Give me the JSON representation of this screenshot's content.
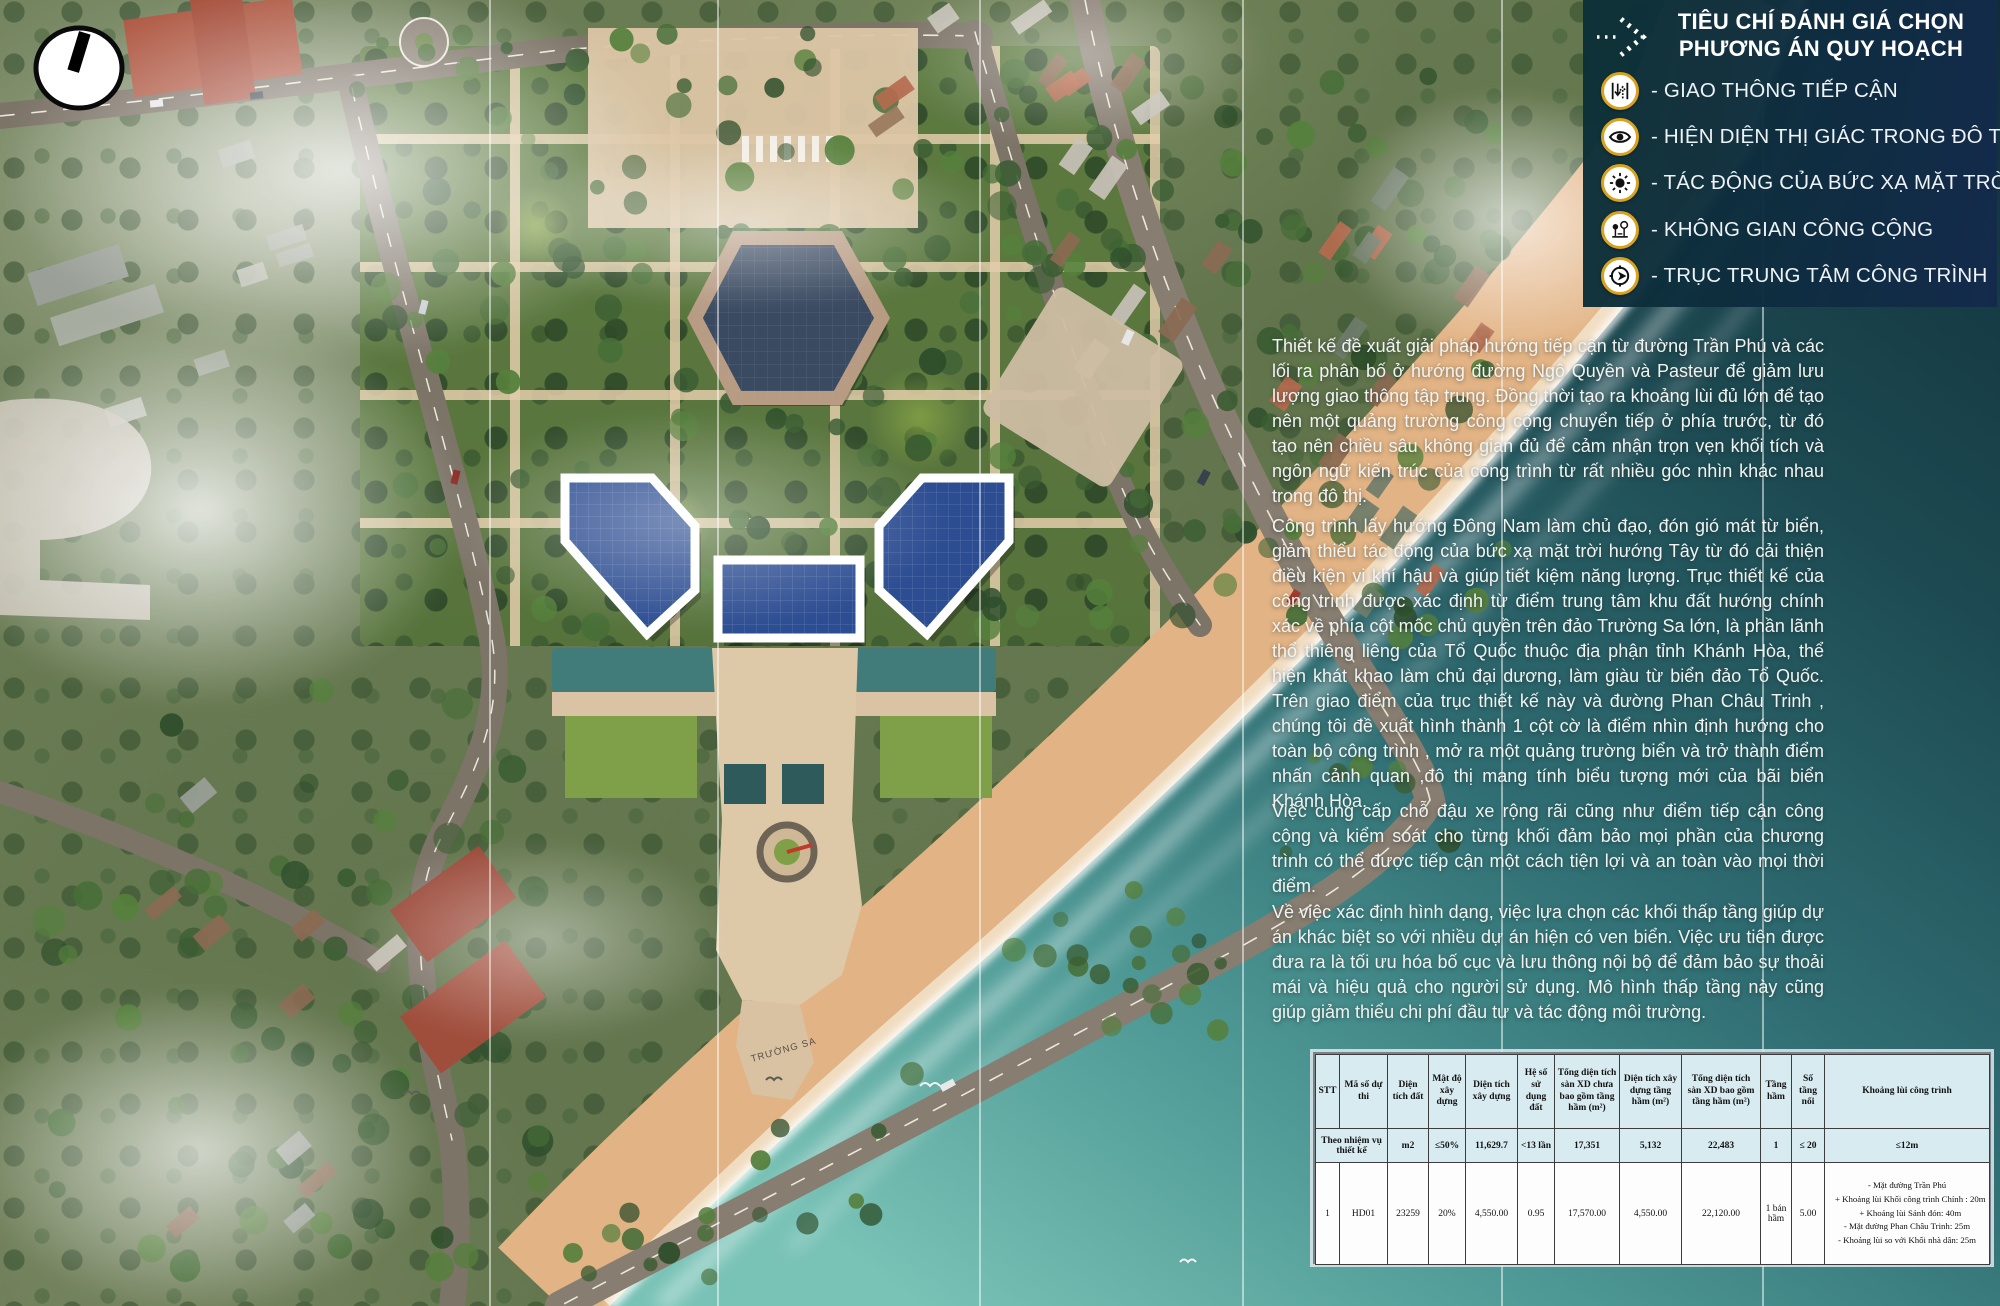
{
  "site": {
    "pier_label": "TRƯỜNG SA"
  },
  "legend": {
    "title_line1": "TIÊU CHÍ ĐÁNH GIÁ CHỌN",
    "title_line2": "PHƯƠNG ÁN QUY HOẠCH",
    "items": [
      {
        "icon": "traffic-access-icon",
        "label": "- GIAO THÔNG TIẾP CẬN"
      },
      {
        "icon": "eye-icon",
        "label": "- HIỆN DIỆN THỊ GIÁC TRONG ĐÔ THỊ"
      },
      {
        "icon": "sun-icon",
        "label": "- TÁC ĐỘNG CỦA BỨC XẠ MẶT TRỜI"
      },
      {
        "icon": "public-space-icon",
        "label": "- KHÔNG GIAN CÔNG CỘNG"
      },
      {
        "icon": "central-axis-icon",
        "label": "- TRỤC TRUNG TÂM CÔNG TRÌNH"
      }
    ],
    "colors": {
      "panel_start": "#0c3037",
      "panel_end": "#142a4c",
      "icon_ring": "#d9a21f"
    }
  },
  "paragraphs": {
    "p1": "Thiết kế đề xuất giải pháp hướng tiếp cận từ đường Trần Phú và các lối ra phân bố ở hướng đường Ngô Quyền và Pasteur để giảm lưu lượng giao thông tập trung. Đồng thời tạo ra khoảng lùi đủ lớn để tạo nên một quảng trường công cộng chuyển tiếp ở phía trước, từ đó tạo nên chiều sâu không gian đủ để cảm nhận trọn vẹn khối tích và ngôn ngữ kiến trúc của công trình từ rất nhiều góc nhìn khác nhau trong đô thị.",
    "p2": "Công trình lấy hướng Đông Nam làm chủ đạo, đón gió mát từ biển, giảm thiểu tác động của bức xạ mặt trời hướng Tây từ đó cải thiện điều kiện vi khí hậu và giúp tiết kiệm năng lượng. Trục thiết kế của công trình được xác định từ điểm trung tâm khu đất hướng chính xác về phía cột mốc chủ quyền trên đảo Trường Sa lớn, là phần lãnh thổ thiêng liêng của Tổ Quốc thuộc địa phận tỉnh Khánh Hòa, thể hiện khát khao làm chủ đại dương, làm giàu từ biển đảo Tổ Quốc. Trên giao điểm của trục thiết kế này và đường Phan Châu Trinh , chúng tôi đề xuất hình thành 1 cột cờ là điểm nhìn định hướng cho toàn bộ công trình , mở ra một quảng trường biển và trở thành điểm nhấn cảnh quan ,đô thị mang tính biểu tượng mới của bãi biển Khánh Hòa.",
    "p3": "Việc cung cấp chỗ đậu xe rộng rãi cũng như điểm tiếp cận công cộng và kiểm soát cho từng khối đảm bảo mọi phần của chương trình có thể được tiếp cận một cách tiện lợi và an toàn vào mọi thời điểm.",
    "p4": "Về việc xác định hình dạng, việc lựa chọn các khối thấp tầng giúp dự án khác biệt so với nhiều dự án hiện có ven biển. Việc ưu tiên được đưa ra là tối ưu hóa bố cục và lưu thông nội bộ để đảm bảo sự thoải mái và hiệu quả cho người sử dụng. Mô hình thấp tầng này cũng giúp giảm thiểu chi phí đầu tư và tác động môi trường."
  },
  "table": {
    "headers": [
      "STT",
      "Mã số dự thi",
      "Diện tích đất",
      "Mật độ xây dựng",
      "Diện tích xây dựng",
      "Hệ số sử dụng đất",
      "Tổng diện tích sàn XD chưa bao gồm tầng hầm (m²)",
      "Diện tích xây dựng tầng hầm (m²)",
      "Tổng diện tích sàn XD bao gồm tầng hầm (m²)",
      "Tầng hầm",
      "Số tầng nổi",
      "Khoảng lùi công trình"
    ],
    "spec_row": {
      "label": "Theo nhiệm vụ thiết kế",
      "values": [
        "m2",
        "≤50%",
        "11,629.7",
        "<13 lần",
        "17,351",
        "5,132",
        "22,483",
        "1",
        "≤ 20",
        "≤12m"
      ]
    },
    "design_row": {
      "stt": "1",
      "code": "HD01",
      "dien_tich_dat": "23259",
      "mat_do_xay_dung": "20%",
      "dien_tich_xay_dung": "4,550.00",
      "he_so_su_dung_dat": "0.95",
      "tong_dt_san_chua_ham": "17,570.00",
      "dt_xay_dung_tang_ham": "4,550.00",
      "tong_dt_san_gom_ham": "22,120.00",
      "tang_ham": "1 bán hầm",
      "so_tang_noi": "5.00",
      "khoang_lui": [
        "- Mặt đường Trần Phú",
        "   + Khoảng lùi Khối công trình Chính : 20m",
        "   + Khoảng lùi Sảnh đón: 40m",
        "- Mặt đường Phan Châu Trinh: 25m",
        "- Khoảng lùi so với Khối nhà dân: 25m"
      ]
    },
    "colors": {
      "header_bg": "#d8ebf1",
      "body_bg": "#fdfdfd"
    }
  },
  "colors": {
    "building_glass_blue": "#2c4d92",
    "hexagon_navy": "#3a4a61",
    "ocean_deep": "#0f2d38",
    "ocean_shallow": "#79c2b6",
    "beach_sand": "#e2b384",
    "legend_gold": "#d9a21f"
  }
}
